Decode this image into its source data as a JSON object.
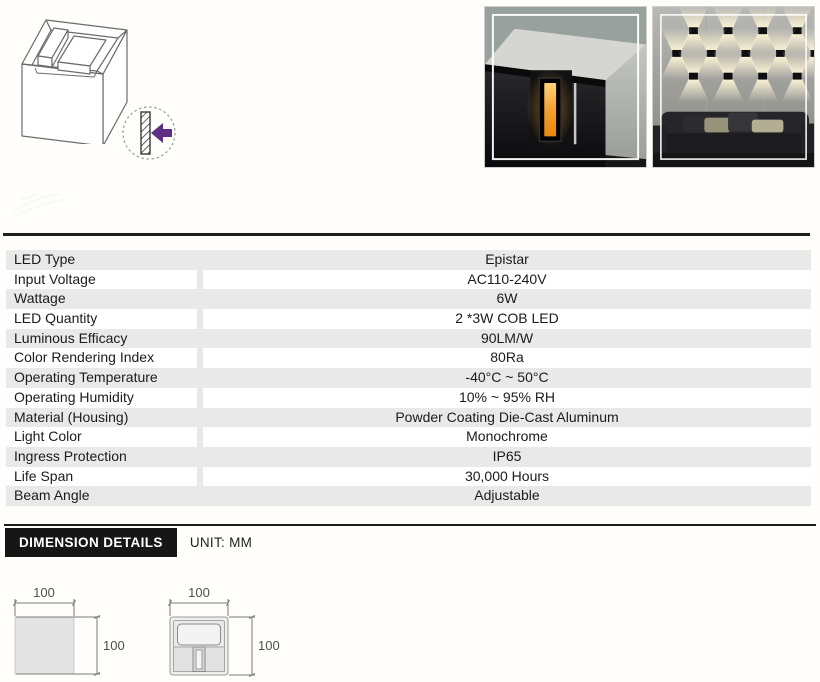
{
  "colors": {
    "accent_purple": "#5e2f82",
    "row_gray": "#e9e9e9",
    "rule_dark": "#1e1e1e",
    "led_orange": "#f2a13c"
  },
  "header": {
    "iso_drawing_icon": "isometric-cube-drawing",
    "mount_icon": "wall-mount-arrow-icon",
    "photo_closeup": "product-photo-closeup",
    "photo_installed": "product-photo-wall-installed"
  },
  "specs": {
    "rows": [
      {
        "label": "LED Type",
        "value": "Epistar"
      },
      {
        "label": "Input Voltage",
        "value": "AC110-240V"
      },
      {
        "label": "Wattage",
        "value": "6W"
      },
      {
        "label": "LED Quantity",
        "value": "2 *3W COB LED"
      },
      {
        "label": "Luminous Efficacy",
        "value": "90LM/W"
      },
      {
        "label": "Color Rendering Index",
        "value": "80Ra"
      },
      {
        "label": "Operating Temperature",
        "value": "-40°C ~ 50°C"
      },
      {
        "label": "Operating Humidity",
        "value": "10% ~ 95% RH"
      },
      {
        "label": "Material (Housing)",
        "value": "Powder Coating Die-Cast Aluminum"
      },
      {
        "label": "Light Color",
        "value": "Monochrome"
      },
      {
        "label": "Ingress Protection",
        "value": "IP65"
      },
      {
        "label": "Life Span",
        "value": "30,000 Hours"
      },
      {
        "label": "Beam Angle",
        "value": "Adjustable"
      }
    ]
  },
  "dimensions": {
    "title": "DIMENSION DETAILS",
    "unit": "UNIT: MM",
    "side_view": {
      "width": "100",
      "height": "100"
    },
    "front_view": {
      "width": "100",
      "height": "100"
    }
  }
}
